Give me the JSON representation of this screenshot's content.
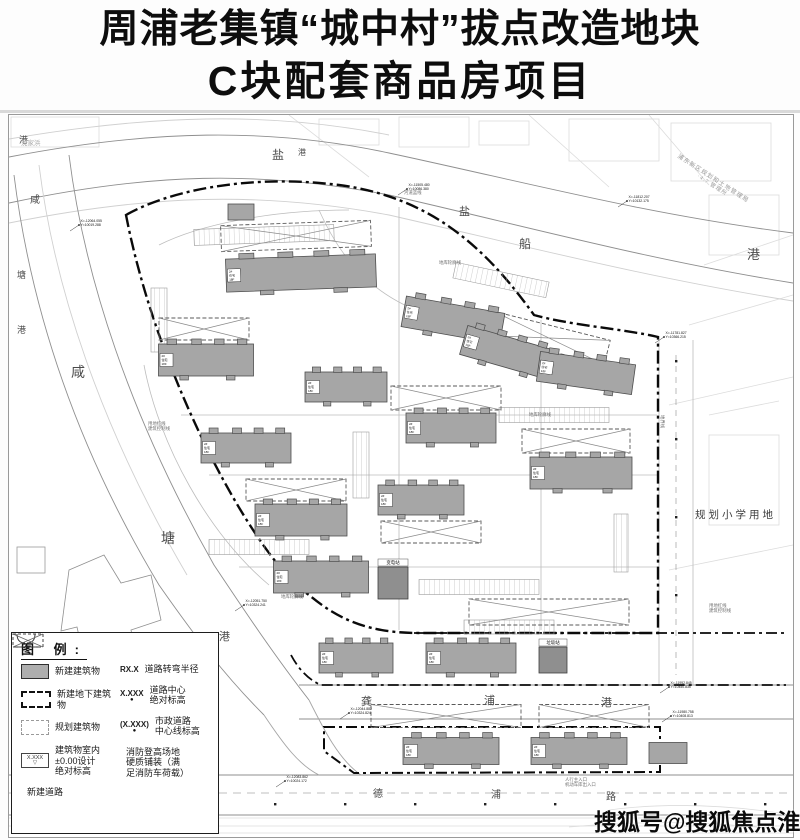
{
  "title": {
    "line1": "周浦老集镇“城中村”拔点改造地块",
    "line2": "C块配套商品房项目"
  },
  "watermark": {
    "text": "搜狐号@搜狐焦点淮南站"
  },
  "legend": {
    "title": "图 例:",
    "left_items": [
      {
        "symbol": "new-building",
        "label": "新建建筑物"
      },
      {
        "symbol": "new-underground",
        "label": "新建地下建筑物"
      },
      {
        "symbol": "planned-building",
        "label": "规划建筑物"
      },
      {
        "symbol": "indoor-elevation",
        "symbol_text": "X.XXX",
        "label": "建筑物室内\n±0.00设计\n绝对标高"
      },
      {
        "symbol": "new-road",
        "label": "新建道路"
      }
    ],
    "right_items": [
      {
        "symbol": "turn-radius",
        "symbol_text": "RX.X",
        "label": "道路转弯半径"
      },
      {
        "symbol": "road-elevation",
        "symbol_text": "X.XXX",
        "label": "道路中心\n绝对标高"
      },
      {
        "symbol": "municipal-elevation",
        "symbol_text": "(X.XXX)",
        "label": "市政道路\n中心线标高"
      },
      {
        "symbol": "fire-pad",
        "label": "消防登高场地\n硬质铺装（满\n足消防车荷载）"
      }
    ]
  },
  "map": {
    "building_label": "2# 住宅 18F",
    "river_labels": [
      {
        "name": "盐船港",
        "chars": [
          {
            "ch": "盐",
            "x": 263,
            "y": 44,
            "size": 12
          },
          {
            "ch": "港",
            "x": 289,
            "y": 40,
            "size": 8
          },
          {
            "ch": "盐",
            "x": 450,
            "y": 100,
            "size": 11
          },
          {
            "ch": "船",
            "x": 510,
            "y": 133,
            "size": 12
          },
          {
            "ch": "港",
            "x": 738,
            "y": 144,
            "size": 13
          }
        ]
      },
      {
        "name": "咸塘港",
        "chars": [
          {
            "ch": "港",
            "x": 10,
            "y": 28,
            "size": 9
          },
          {
            "ch": "咸",
            "x": 21,
            "y": 88,
            "size": 10
          },
          {
            "ch": "塘",
            "x": 8,
            "y": 163,
            "size": 9
          },
          {
            "ch": "港",
            "x": 8,
            "y": 218,
            "size": 9
          },
          {
            "ch": "咸",
            "x": 62,
            "y": 262,
            "size": 14
          },
          {
            "ch": "塘",
            "x": 152,
            "y": 428,
            "size": 14
          },
          {
            "ch": "港",
            "x": 210,
            "y": 525,
            "size": 11
          }
        ]
      },
      {
        "name": "龚浦港",
        "chars": [
          {
            "ch": "龚",
            "x": 352,
            "y": 590,
            "size": 11
          },
          {
            "ch": "浦",
            "x": 475,
            "y": 589,
            "size": 11
          },
          {
            "ch": "港",
            "x": 592,
            "y": 591,
            "size": 11
          }
        ]
      }
    ],
    "road_labels": [
      {
        "name": "德浦路",
        "chars": [
          {
            "ch": "德",
            "x": 364,
            "y": 682,
            "size": 10
          },
          {
            "ch": "浦",
            "x": 482,
            "y": 683,
            "size": 10
          },
          {
            "ch": "路",
            "x": 597,
            "y": 685,
            "size": 10
          }
        ]
      }
    ],
    "area_labels": [
      {
        "text": "规划小学用地",
        "x": 686,
        "y": 403,
        "size": 10.5,
        "spacing": 3,
        "rot": 0,
        "color": "#3c3c3c"
      },
      {
        "text": "浦东新区规划和土地管理局",
        "x": 668,
        "y": 42,
        "size": 6,
        "spacing": 1,
        "rot": 33,
        "color": "#9a9a9a"
      },
      {
        "text": "·4.7 管理所",
        "x": 688,
        "y": 62,
        "size": 5.5,
        "spacing": 1,
        "rot": 33,
        "color": "#9a9a9a"
      },
      {
        "text": "沈家浜",
        "x": 12,
        "y": 30,
        "size": 6.5,
        "spacing": 0,
        "rot": 0,
        "color": "#a8a8a8"
      }
    ],
    "buildings": [
      {
        "x": 292,
        "y": 158,
        "w": 150,
        "h": 33,
        "rot": -2
      },
      {
        "x": 232,
        "y": 97,
        "w": 26,
        "h": 16,
        "rot": 0,
        "plain": true
      },
      {
        "x": 444,
        "y": 205,
        "w": 100,
        "h": 31,
        "rot": 10
      },
      {
        "x": 497,
        "y": 237,
        "w": 88,
        "h": 30,
        "rot": 16
      },
      {
        "x": 577,
        "y": 258,
        "w": 96,
        "h": 30,
        "rot": 8
      },
      {
        "x": 572,
        "y": 358,
        "w": 102,
        "h": 32,
        "rot": 0
      },
      {
        "x": 197,
        "y": 245,
        "w": 95,
        "h": 32,
        "rot": 0
      },
      {
        "x": 337,
        "y": 272,
        "w": 82,
        "h": 30,
        "rot": 0
      },
      {
        "x": 442,
        "y": 313,
        "w": 90,
        "h": 30,
        "rot": 0
      },
      {
        "x": 237,
        "y": 333,
        "w": 90,
        "h": 30,
        "rot": 0
      },
      {
        "x": 292,
        "y": 405,
        "w": 92,
        "h": 32,
        "rot": 0
      },
      {
        "x": 412,
        "y": 385,
        "w": 86,
        "h": 30,
        "rot": 0
      },
      {
        "x": 312,
        "y": 462,
        "w": 95,
        "h": 32,
        "rot": 0
      },
      {
        "x": 347,
        "y": 543,
        "w": 74,
        "h": 30,
        "rot": 0
      },
      {
        "x": 462,
        "y": 543,
        "w": 90,
        "h": 30,
        "rot": 0
      },
      {
        "x": 442,
        "y": 636,
        "w": 96,
        "h": 27,
        "rot": 0
      },
      {
        "x": 570,
        "y": 636,
        "w": 96,
        "h": 27,
        "rot": 0
      },
      {
        "x": 659,
        "y": 638,
        "w": 38,
        "h": 21,
        "rot": 0,
        "plain": true
      }
    ],
    "facilities": [
      {
        "label": "变电站",
        "x": 384,
        "y": 468,
        "w": 30,
        "h": 32
      },
      {
        "label": "垃圾站",
        "x": 544,
        "y": 545,
        "w": 28,
        "h": 26
      }
    ],
    "coord_labels": [
      {
        "l1": "X=-11505.480",
        "l2": "Y=10086.380",
        "x": 398,
        "y": 74
      },
      {
        "l1": "X=-11812.207",
        "l2": "Y=10132.175",
        "x": 618,
        "y": 86
      },
      {
        "l1": "X=-12064.055",
        "l2": "Y=10019.288",
        "x": 70,
        "y": 110
      },
      {
        "l1": "X=-11781.827",
        "l2": "Y=10366.215",
        "x": 655,
        "y": 222
      },
      {
        "l1": "X=-11952.845",
        "l2": "Y=10450.835",
        "x": 660,
        "y": 572
      },
      {
        "l1": "X=-11980.758",
        "l2": "Y=10408.813",
        "x": 662,
        "y": 601
      },
      {
        "l1": "X=-12051.750",
        "l2": "Y=10324.241",
        "x": 235,
        "y": 490
      },
      {
        "l1": "X=-12083.862",
        "l2": "Y=10024.172",
        "x": 276,
        "y": 666
      },
      {
        "l1": "X=-12044.882",
        "l2": "Y=10324.824",
        "x": 340,
        "y": 598
      }
    ],
    "notes": [
      {
        "text": "河道蓝线",
        "x": 395,
        "y": 79,
        "rot": 0
      },
      {
        "text": "地库轮廓线",
        "x": 272,
        "y": 483,
        "rot": 0
      },
      {
        "text": "地库轮廓线",
        "x": 520,
        "y": 301,
        "rot": 0
      },
      {
        "text": "地库轮廓线",
        "x": 430,
        "y": 149,
        "rot": 0
      },
      {
        "text": "用地红线\n建筑控制线",
        "x": 700,
        "y": 492,
        "rot": 0
      },
      {
        "text": "用地红线\n建筑控制线",
        "x": 139,
        "y": 310,
        "rot": 0
      },
      {
        "text": "人行主入口\n机动车库出入口",
        "x": 556,
        "y": 666,
        "rot": 0
      },
      {
        "text": "地界线",
        "x": 652,
        "y": 300,
        "rot": 90
      }
    ],
    "parking": [
      {
        "x": 255,
        "y": 120,
        "w": 140,
        "h": 16,
        "rot": -2
      },
      {
        "x": 150,
        "y": 205,
        "w": 16,
        "h": 64,
        "rot": 0
      },
      {
        "x": 492,
        "y": 165,
        "w": 95,
        "h": 16,
        "rot": 12
      },
      {
        "x": 545,
        "y": 300,
        "w": 110,
        "h": 15,
        "rot": 0
      },
      {
        "x": 352,
        "y": 350,
        "w": 16,
        "h": 66,
        "rot": 0
      },
      {
        "x": 250,
        "y": 432,
        "w": 100,
        "h": 15,
        "rot": 0
      },
      {
        "x": 470,
        "y": 472,
        "w": 120,
        "h": 15,
        "rot": 0
      },
      {
        "x": 612,
        "y": 428,
        "w": 14,
        "h": 58,
        "rot": 0
      },
      {
        "x": 500,
        "y": 512,
        "w": 90,
        "h": 14,
        "rot": 0
      }
    ],
    "fire_lanes": [
      {
        "x": 287,
        "y": 121,
        "w": 150,
        "h": 26,
        "rot": -2
      },
      {
        "x": 540,
        "y": 223,
        "w": 120,
        "h": 25,
        "rot": 14
      },
      {
        "x": 195,
        "y": 214,
        "w": 90,
        "h": 22,
        "rot": 0
      },
      {
        "x": 437,
        "y": 283,
        "w": 110,
        "h": 24,
        "rot": 0
      },
      {
        "x": 567,
        "y": 326,
        "w": 108,
        "h": 24,
        "rot": 0
      },
      {
        "x": 287,
        "y": 375,
        "w": 100,
        "h": 22,
        "rot": 0
      },
      {
        "x": 422,
        "y": 417,
        "w": 100,
        "h": 22,
        "rot": 0
      },
      {
        "x": 540,
        "y": 497,
        "w": 160,
        "h": 26,
        "rot": 0
      },
      {
        "x": 437,
        "y": 601,
        "w": 150,
        "h": 23,
        "rot": 0
      },
      {
        "x": 585,
        "y": 601,
        "w": 110,
        "h": 23,
        "rot": 0
      }
    ]
  }
}
